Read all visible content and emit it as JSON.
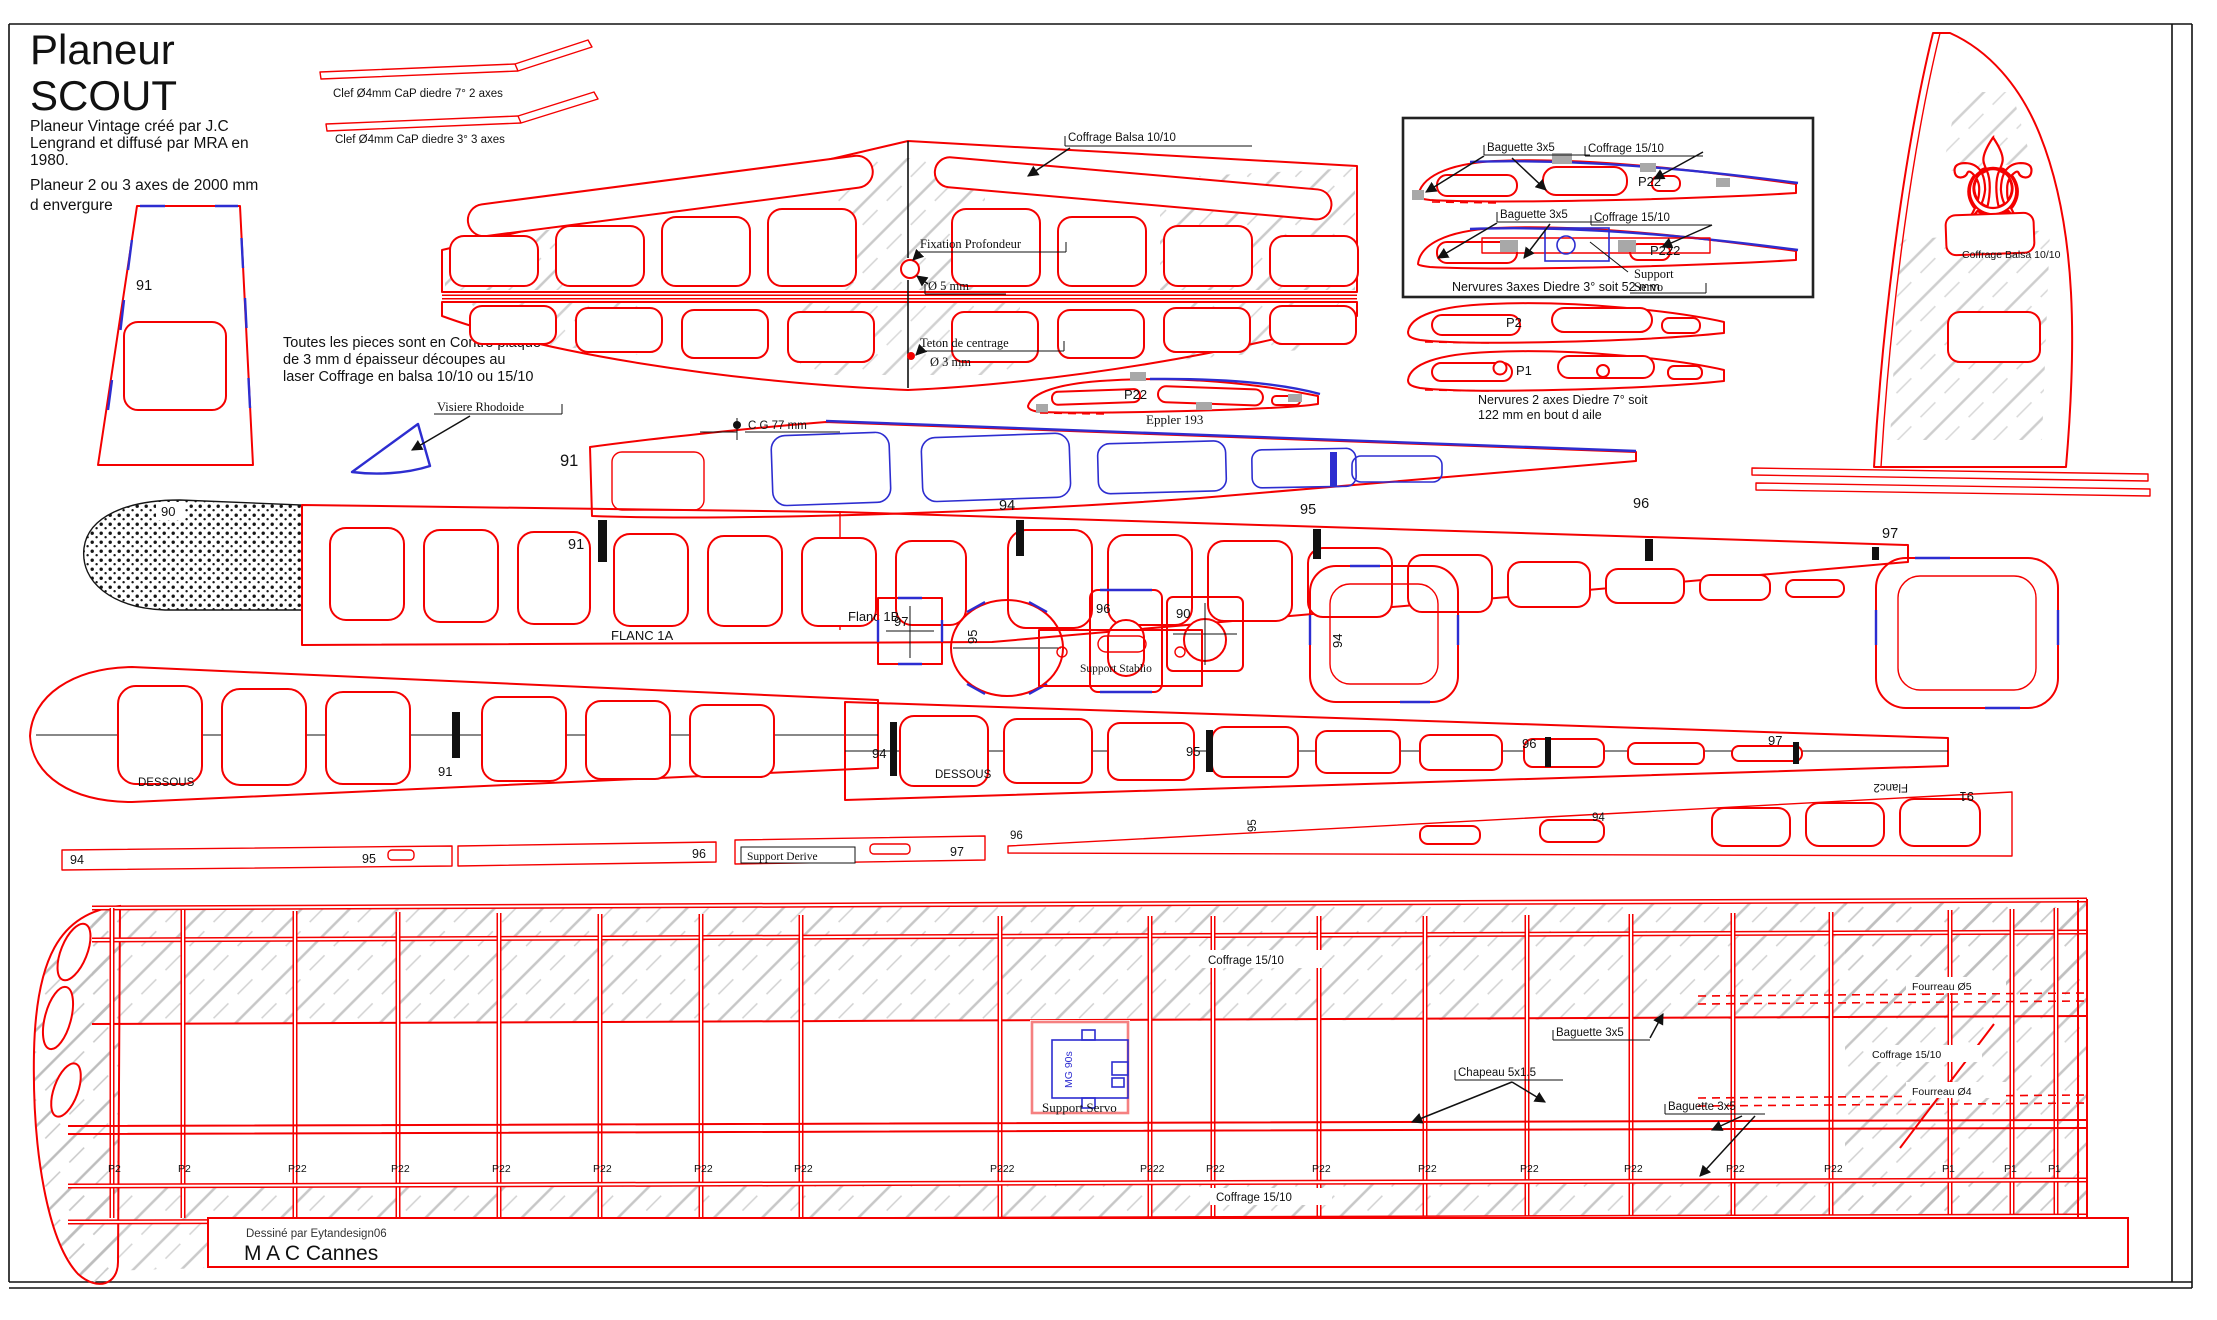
{
  "header": {
    "title_line1": "Planeur",
    "title_line2": "SCOUT",
    "subtitle_lines": [
      "Planeur Vintage créé par J.C",
      "Lengrand et diffusé par MRA en",
      "1980.",
      "Planeur 2 ou 3 axes de 2000 mm",
      "d envergure"
    ]
  },
  "notes": {
    "lines": [
      "Toutes les pieces sont en Contre plaque",
      "de 3 mm d épaisseur découpes au",
      "laser  Coffrage en balsa 10/10 ou 15/10"
    ]
  },
  "clef": {
    "label_2axes": "Clef Ø4mm CaP  diedre 7° 2 axes",
    "label_3axes": "Clef Ø4mm CaP  diedre 3° 3 axes"
  },
  "stab": {
    "coffrage": "Coffrage Balsa 10/10",
    "fixation": "Fixation Profondeur",
    "dia5": "Ø 5 mm",
    "teton": "Teton de centrage",
    "dia3": "Ø 3 mm"
  },
  "eppler": {
    "ref": "P22",
    "name": "Eppler 193"
  },
  "detail_box": {
    "rib1": {
      "baguette": "Baguette 3x5",
      "coffrage": "Coffrage 15/10",
      "ref": "P22"
    },
    "rib2": {
      "baguette": "Baguette 3x5",
      "coffrage": "Coffrage 15/10",
      "ref": "P222",
      "support_line1": "Support",
      "support_line2": "Servo"
    },
    "caption": "Nervures 3axes Diedre 3°  soit 52 mm"
  },
  "tip_ribs": {
    "p2": "P2",
    "p1": "P1",
    "caption_line1": "Nervures 2 axes Diedre 7° soit",
    "caption_line2": "122 mm en bout d aile"
  },
  "fin": {
    "coffrage": "Coffrage Balsa 10/10"
  },
  "fuselage": {
    "num_91_top": "91",
    "visiere": "Visiere Rhodoide",
    "cg": "C G 77 mm",
    "num_91_side": "91",
    "num_90": "90",
    "num_91_flanc": "91",
    "num_94": "94",
    "num_95": "95",
    "num_96": "96",
    "num_97": "97",
    "flanc1a": "FLANC 1A",
    "flanc1b": "Flanc 1B"
  },
  "formers": {
    "f97": "97",
    "f95": "95",
    "f96": "96",
    "f90": "90",
    "f94": "94"
  },
  "dessous": {
    "support_stablio": "Support Stablio",
    "left_label": "DESSOUS",
    "left_91": "91",
    "right_94": "94",
    "right_label": "DESSOUS",
    "right_95": "95",
    "right_96": "96",
    "right_97": "97"
  },
  "strips": {
    "s94": "94",
    "s95": "95",
    "s96": "96",
    "support_derive": "Support  Derive",
    "s97": "97",
    "flanc2_96": "96",
    "flanc2_95": "95",
    "flanc2_94": "94",
    "flanc2_name": "Flanc2",
    "flanc2_91": "91"
  },
  "wing": {
    "coffrage_top": "Coffrage 15/10",
    "coffrage_bottom": "Coffrage 15/10",
    "coffrage_tip": "Coffrage 15/10",
    "fourreau_5": "Fourreau Ø5",
    "fourreau_4": "Fourreau Ø4",
    "baguette_top": "Baguette 3x5",
    "chapeau": "Chapeau 5x1.5",
    "baguette_bottom": "Baguette 3x5",
    "servo_model": "MG 90s",
    "support_servo": "Support Servo",
    "rib_labels": [
      {
        "t": "P2",
        "x": 108
      },
      {
        "t": "P2",
        "x": 178
      },
      {
        "t": "P22",
        "x": 288
      },
      {
        "t": "P22",
        "x": 391
      },
      {
        "t": "P22",
        "x": 492
      },
      {
        "t": "P22",
        "x": 593
      },
      {
        "t": "P22",
        "x": 694
      },
      {
        "t": "P22",
        "x": 794
      },
      {
        "t": "P222",
        "x": 990
      },
      {
        "t": "P222",
        "x": 1140
      },
      {
        "t": "P22",
        "x": 1206
      },
      {
        "t": "P22",
        "x": 1312
      },
      {
        "t": "P22",
        "x": 1418
      },
      {
        "t": "P22",
        "x": 1520
      },
      {
        "t": "P22",
        "x": 1624
      },
      {
        "t": "P22",
        "x": 1726
      },
      {
        "t": "P22",
        "x": 1824
      },
      {
        "t": "P1",
        "x": 1942
      },
      {
        "t": "P1",
        "x": 2004
      },
      {
        "t": "P1",
        "x": 2048
      }
    ]
  },
  "credits": {
    "designer": "Dessiné par Eytandesign06",
    "club": "M A C Cannes"
  },
  "colors": {
    "outline_red": "#f40000",
    "accent_blue": "#2d2dd0",
    "hatch_gray": "#bdbdbd"
  }
}
